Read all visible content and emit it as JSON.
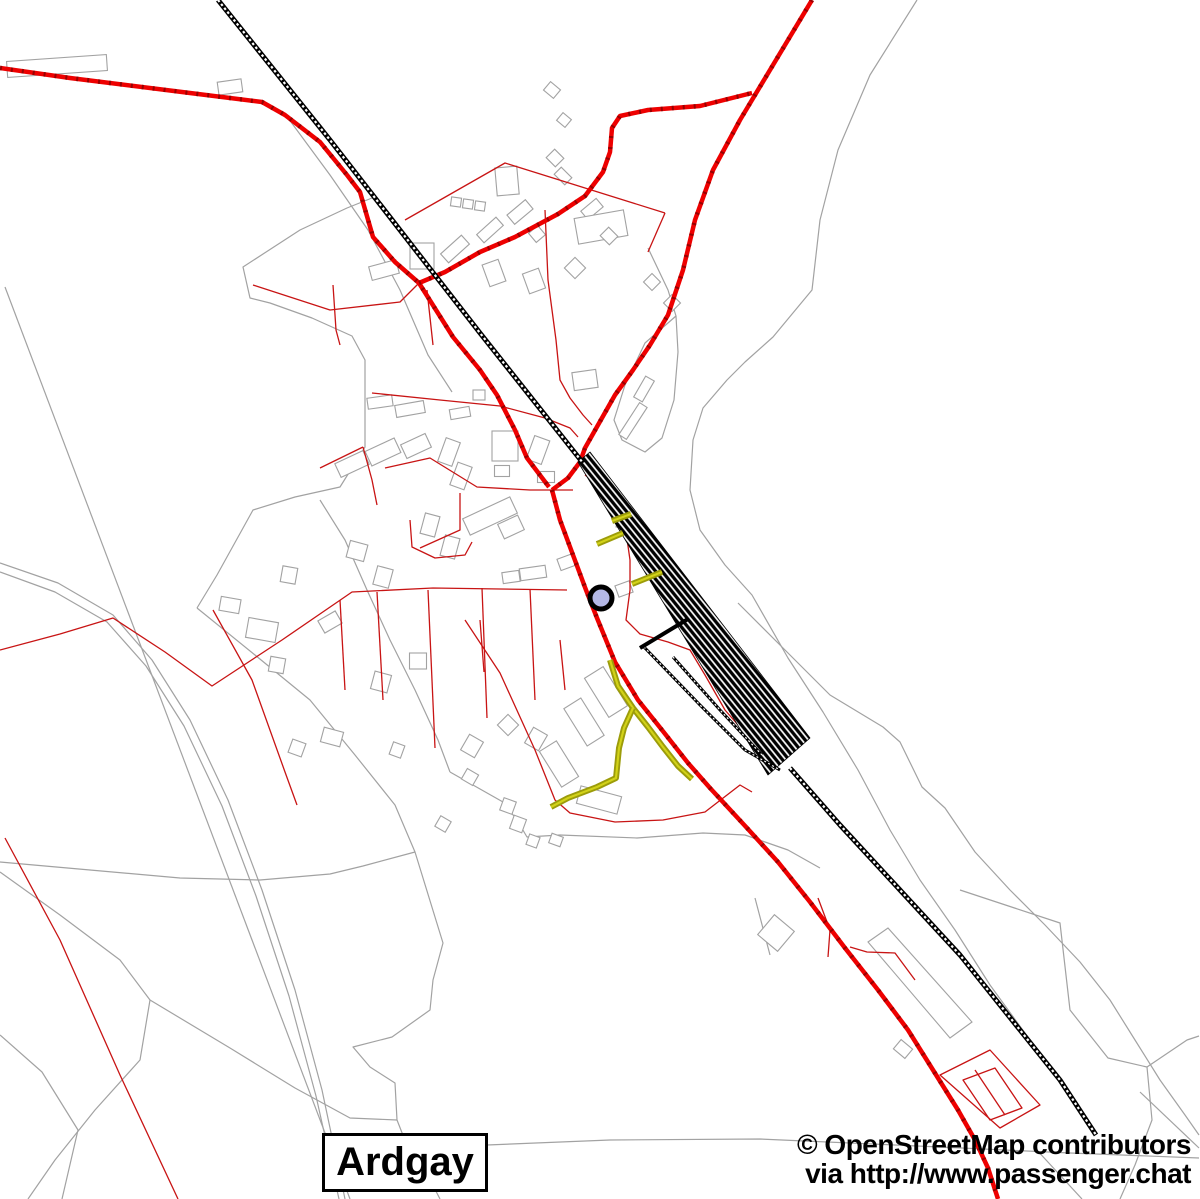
{
  "labels": {
    "place": "Ardgay",
    "attribution1": "© OpenStreetMap contributors",
    "attribution2": "via http://www.passenger.chat"
  },
  "colors": {
    "background": "#ffffff",
    "road_major": "#ee0000",
    "road_major_tick": "#990000",
    "road_minor": "#c81414",
    "boundary": "#a2a2a2",
    "building_fill": "#ffffff",
    "railway": "#000000",
    "footpath": "#9c9c0a",
    "footpath_core": "#d2d218",
    "marker_fill": "#b4b8e6",
    "marker_stroke": "#000000"
  },
  "marker": {
    "name": "poi-node-marker",
    "cx": 601,
    "cy": 598,
    "r": 11,
    "stroke_width": 5
  },
  "layers": [
    {
      "name": "boundary-lines",
      "kind": "paths",
      "stroke": "#a2a2a2",
      "width": 1.2,
      "paths": [
        "M5,287 L350,1199",
        "M0,563 L58,583 L113,615 L152,660 L190,720 L228,800 L262,890 L295,990 L322,1090 L345,1199",
        "M0,572 L55,592 L107,622 L146,666 L184,726 L222,806 L256,896 L289,996 L316,1096 L339,1199",
        "M372,198 L347,208 L300,230 L243,267 L250,298 L270,303 L312,318 L352,336 L365,360 L365,447 L340,487 L295,497 L253,510 L217,575 L197,608",
        "M320,500 L345,540 L367,590 L390,640 L415,690 L438,740 L450,772",
        "M450,772 L503,802 L517,820 L527,837 L560,835 L637,838 L703,833 L745,835 L788,850 L820,868",
        "M197,608 L255,655 L310,700 L355,755 L395,805 L415,852 L443,943 L433,980 L430,1010 L392,1037 L353,1047 L370,1067 L395,1083 L397,1120 L408,1148 L425,1170 L440,1199",
        "M415,852 L363,866 L330,874 L260,880 L180,878 L90,870 L0,862",
        "M0,872 L60,915 L120,960 L150,1000 L140,1060 L95,1110 L55,1160 L28,1199",
        "M0,1035 L42,1072 L78,1130 L62,1199",
        "M150,1000 L230,1048 L295,1088 L350,1118 L397,1120",
        "M487,1145 L610,1140 L760,1139 L940,1147 L1070,1153 L1199,1158",
        "M1035,1148 L1082,1199",
        "M1140,1092 L1199,1148",
        "M288,118 L330,175 L368,230 L400,290 L428,355 L452,392",
        "M648,248 L668,290 L676,316",
        "M676,316 L645,343 L625,385 L614,420 L622,440 L645,452 L662,438 L674,400 L678,352 Z",
        "M917,0 L870,75 L838,150 L820,220 L812,290 L773,337 L745,362 L727,380 L703,408 L693,440 L690,490 L700,530 L725,565 L752,595 L788,658 L823,712 L858,770 L890,830 L920,880 L955,930 L990,985 L1030,1040 L1062,1085 L1088,1125",
        "M738,603 L785,650 L830,695 L883,727 L900,742 L922,787 L945,808 L975,852 L1010,890 L1045,925 L1080,962 L1110,1000 L1135,1040 L1160,1080 L1185,1115 L1199,1135",
        "M960,890 L1060,923 L1070,1010 L1108,1058 L1147,1067 L1187,1040 L1199,1036",
        "M1147,1067 L1152,1120 L1135,1165 L1120,1199",
        "M755,898 L770,955"
      ]
    },
    {
      "name": "buildings",
      "kind": "buildings",
      "stroke": "#a2a2a2",
      "width": 1.1,
      "fill": "#ffffff",
      "rects": [
        [
          57,
          66,
          100,
          16,
          -4
        ],
        [
          230,
          87,
          24,
          13,
          -8
        ],
        [
          384,
          270,
          28,
          14,
          -15
        ],
        [
          552,
          90,
          13,
          11,
          40
        ],
        [
          564,
          120,
          11,
          10,
          40
        ],
        [
          422,
          256,
          24,
          26,
          0
        ],
        [
          456,
          202,
          10,
          9,
          8
        ],
        [
          468,
          204,
          10,
          9,
          8
        ],
        [
          480,
          206,
          10,
          9,
          8
        ],
        [
          507,
          181,
          22,
          28,
          -5
        ],
        [
          520,
          212,
          24,
          12,
          -40
        ],
        [
          490,
          230,
          26,
          11,
          -42
        ],
        [
          455,
          249,
          28,
          12,
          -42
        ],
        [
          537,
          234,
          12,
          12,
          -40
        ],
        [
          592,
          209,
          20,
          11,
          -40
        ],
        [
          601,
          227,
          50,
          26,
          -10
        ],
        [
          555,
          158,
          13,
          12,
          45
        ],
        [
          563,
          176,
          15,
          10,
          45
        ],
        [
          609,
          236,
          13,
          12,
          45
        ],
        [
          494,
          273,
          17,
          23,
          -20
        ],
        [
          534,
          281,
          17,
          21,
          -20
        ],
        [
          575,
          268,
          15,
          15,
          45
        ],
        [
          652,
          282,
          12,
          12,
          45
        ],
        [
          672,
          303,
          12,
          12,
          45
        ],
        [
          585,
          380,
          24,
          18,
          -8
        ],
        [
          644,
          389,
          10,
          24,
          30
        ],
        [
          633,
          421,
          9,
          38,
          33
        ],
        [
          623,
          522,
          12,
          12,
          10
        ],
        [
          380,
          402,
          25,
          11,
          -8
        ],
        [
          410,
          409,
          29,
          12,
          -10
        ],
        [
          460,
          413,
          20,
          10,
          -10
        ],
        [
          479,
          395,
          12,
          10,
          0
        ],
        [
          352,
          464,
          31,
          15,
          -25
        ],
        [
          383,
          452,
          32,
          16,
          -25
        ],
        [
          416,
          446,
          27,
          15,
          -25
        ],
        [
          449,
          452,
          15,
          25,
          20
        ],
        [
          461,
          476,
          15,
          24,
          20
        ],
        [
          505,
          446,
          26,
          30,
          0
        ],
        [
          502,
          471,
          15,
          11,
          0
        ],
        [
          546,
          477,
          17,
          11,
          0
        ],
        [
          538,
          450,
          16,
          25,
          20
        ],
        [
          490,
          516,
          52,
          18,
          -25
        ],
        [
          511,
          527,
          22,
          16,
          -25
        ],
        [
          430,
          525,
          15,
          21,
          15
        ],
        [
          450,
          547,
          15,
          21,
          15
        ],
        [
          357,
          551,
          18,
          17,
          15
        ],
        [
          383,
          577,
          16,
          19,
          15
        ],
        [
          511,
          577,
          17,
          11,
          -8
        ],
        [
          533,
          573,
          26,
          12,
          -8
        ],
        [
          567,
          562,
          17,
          12,
          -20
        ],
        [
          624,
          589,
          15,
          12,
          -20
        ],
        [
          289,
          575,
          15,
          16,
          10
        ],
        [
          230,
          605,
          20,
          14,
          10
        ],
        [
          262,
          630,
          30,
          20,
          10
        ],
        [
          277,
          665,
          15,
          15,
          10
        ],
        [
          330,
          622,
          20,
          14,
          -30
        ],
        [
          418,
          661,
          17,
          16,
          0
        ],
        [
          381,
          682,
          17,
          18,
          15
        ],
        [
          332,
          737,
          20,
          15,
          15
        ],
        [
          397,
          750,
          12,
          13,
          20
        ],
        [
          297,
          748,
          14,
          14,
          20
        ],
        [
          606,
          692,
          22,
          46,
          -32
        ],
        [
          584,
          722,
          20,
          44,
          -32
        ],
        [
          559,
          764,
          20,
          42,
          -32
        ],
        [
          599,
          800,
          42,
          18,
          15
        ],
        [
          536,
          739,
          16,
          18,
          30
        ],
        [
          508,
          725,
          15,
          15,
          45
        ],
        [
          472,
          746,
          16,
          18,
          30
        ],
        [
          508,
          806,
          13,
          13,
          20
        ],
        [
          518,
          824,
          13,
          14,
          20
        ],
        [
          533,
          841,
          11,
          11,
          20
        ],
        [
          556,
          840,
          12,
          10,
          20
        ],
        [
          470,
          777,
          13,
          12,
          30
        ],
        [
          443,
          824,
          12,
          12,
          30
        ],
        [
          903,
          1049,
          15,
          12,
          40
        ],
        [
          776,
          933,
          26,
          26,
          40
        ]
      ],
      "polys": [
        "M868,942 L888,928 L972,1022 L950,1038 Z"
      ]
    },
    {
      "name": "minor-red-lines",
      "kind": "paths",
      "stroke": "#c81414",
      "width": 1.3,
      "paths": [
        "M253,285 L330,310 L400,302 L419,283",
        "M333,285 L336,330 L340,345",
        "M405,220 L505,163 L665,213",
        "M665,213 L648,252",
        "M545,210 L548,280 L556,340 L560,380 L570,398 L583,415 L592,425",
        "M372,393 L440,400 L500,406 L545,418 L570,428 L578,437",
        "M0,650 L60,634 L113,618 L165,652 L212,686 L282,640 L352,592 L433,588 L500,589 L567,590",
        "M213,610 L252,680 L285,772 L297,805",
        "M340,600 L345,690",
        "M377,592 L383,700",
        "M428,590 L435,748",
        "M482,588 L487,718",
        "M530,589 L535,700",
        "M480,620 L484,672",
        "M560,640 L565,690",
        "M465,620 L500,673 L535,750 L555,800 L570,813 L615,822 L663,820 L705,812 L740,785 L752,792",
        "M5,838 L60,940 L120,1075 L178,1199",
        "M585,475 L612,495 L625,525 L630,560 L630,590 L626,620 L640,634 L668,642 L690,650 L705,675 L725,710 L745,733 L762,750",
        "M940,1075 L990,1050 L1040,1105 L1000,1128 Z",
        "M963,1080 L995,1068 L1022,1108 L990,1120 Z",
        "M975,1070 L1005,1115",
        "M850,947 L867,952 L895,953 L915,980",
        "M385,468 L430,458 L477,487 L530,490 L573,490",
        "M460,493 L460,530 L420,548",
        "M410,520 L412,547 L435,558 L465,555 L472,542",
        "M363,447 L372,480 L377,505",
        "M363,447 L320,468",
        "M427,290 L433,345",
        "M818,898 L830,930 L828,957"
      ]
    },
    {
      "name": "major-roads",
      "kind": "paths",
      "stroke": "#ee0000",
      "width": 4.5,
      "overlay": {
        "stroke": "#990000",
        "width": 4.5,
        "dash": "2,9"
      },
      "paths": [
        "M0,68 L70,78 L190,93 L262,102 L285,115 L320,142 L347,175 L360,192 L373,237 L395,262 L419,283 L453,337 L480,370 L497,395 L515,430 L527,458 L549,487",
        "M812,0 L770,70 L740,120 L713,170 L695,220 L683,270 L668,315 L650,345 L633,370 L615,395 L598,425 L585,448 L580,462 L568,478 L552,490",
        "M419,283 L445,272 L480,252 L515,237 L558,214 L585,196 L603,172 L610,152 L612,128 L620,116 L648,110 L700,106 L752,93",
        "M552,490 L560,520 L573,555 L586,590 L597,618 L615,662 L638,700 L662,730 L688,763 L710,788 L747,828 L778,862 L810,902 L845,948 L878,990 L908,1030 L938,1078 L958,1110 L975,1140 L988,1168 L998,1199"
      ]
    },
    {
      "name": "railway-station-band",
      "kind": "paths",
      "stroke": "#000000",
      "width": 0.8,
      "fill": "url(#railhatch)",
      "paths": [
        "M578,462 L590,452 L810,738 L768,775 Z"
      ]
    },
    {
      "name": "railway-tracks",
      "kind": "paths",
      "stroke": "#000000",
      "width": 5,
      "overlay": {
        "stroke": "#ffffff",
        "width": 2.2,
        "dash": "2.5,2.5"
      },
      "paths": [
        "M218,0 L330,140 L480,333 L583,463",
        "M790,768 L840,825 L900,890 L960,955 L1020,1030 L1060,1080 L1096,1135"
      ]
    },
    {
      "name": "railway-sidings",
      "kind": "paths",
      "stroke": "#000000",
      "width": 3,
      "overlay": {
        "stroke": "#ffffff",
        "width": 1.2,
        "dash": "2,2.5"
      },
      "paths": [
        "M644,647 L700,705 L745,750 L780,770",
        "M673,657 L720,710 L762,755"
      ]
    },
    {
      "name": "station-platform",
      "kind": "paths",
      "stroke": "#000000",
      "width": 4,
      "paths": [
        "M640,648 L688,619"
      ]
    },
    {
      "name": "footpaths",
      "kind": "paths",
      "stroke": "#9c9c0a",
      "width": 6,
      "overlay": {
        "stroke": "#d2d218",
        "width": 2.2
      },
      "paths": [
        "M597,544 L623,533",
        "M612,521 L631,514",
        "M632,584 L662,572",
        "M610,660 L618,686 L633,708 L648,727 L663,747 L678,766 L692,779",
        "M633,708 L624,728 L619,748 L617,768 L616,778 L597,787 L568,798 L551,807"
      ]
    }
  ]
}
